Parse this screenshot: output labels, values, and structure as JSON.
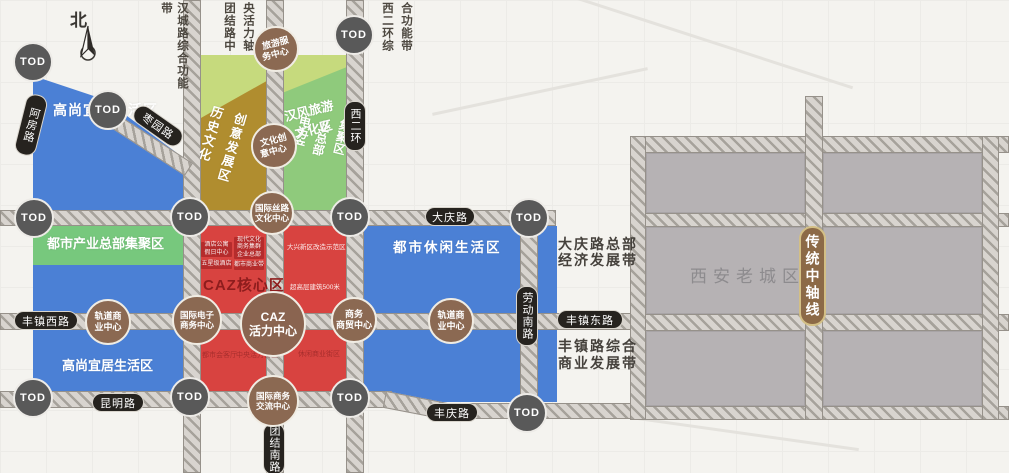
{
  "compass": {
    "north": "北"
  },
  "tod_label": "TOD",
  "belts": {
    "hancheng": "汉城路综合功能带",
    "tuanjie_col_left": "团结路中",
    "tuanjie_col_right": "央活力轴",
    "xierhuan_col_left": "西二环综",
    "xierhuan_col_right": "合功能带",
    "daqing_line1": "大庆路总部",
    "daqing_line2": "经济发展带",
    "fengzhen_line1": "丰镇路综合",
    "fengzhen_line2": "商业发展带"
  },
  "axis_badge": "传统中轴线",
  "old_city_label": "西安老城区",
  "roads": {
    "afang": "阿房路",
    "zaoyuan": "枣园路",
    "xierhuan": "西二环",
    "daqing": "大庆路",
    "fengzhen_west": "丰镇西路",
    "fengzhen_east": "丰镇东路",
    "kunming": "昆明路",
    "fengqing": "丰庆路",
    "tuanjie_south": "团结南路",
    "laodong_south": "劳动南路"
  },
  "zones": {
    "noble1": "高尚宜居生活区",
    "industry_hq": "都市产业总部集聚区",
    "noble2": "高尚宜居生活区",
    "leisure": "都市休闲生活区",
    "caz_core": "CAZ核心区",
    "creative_col1": "历史文化",
    "creative_col2": "创意发展区",
    "hanfeng_line1": "汉风旅游",
    "hanfeng_line2": "文化区",
    "power_col1": "电力产",
    "power_col2": "业总部",
    "power_col3": "集聚区"
  },
  "centers": {
    "travel": {
      "l1": "旅游服",
      "l2": "务中心"
    },
    "creative": {
      "l1": "文化创",
      "l2": "意中心"
    },
    "silk": {
      "l1": "国际丝路",
      "l2": "文化中心"
    },
    "rail1": {
      "l1": "轨道商",
      "l2": "业中心"
    },
    "ecom": {
      "l1": "国际电子",
      "l2": "商务中心"
    },
    "caz": {
      "l1": "CAZ",
      "l2": "活力中心"
    },
    "biztrade": {
      "l1": "商务",
      "l2": "商贸中心"
    },
    "rail2": {
      "l1": "轨道商",
      "l2": "业中心"
    },
    "intl": {
      "l1": "国际商务",
      "l2": "交流中心"
    }
  },
  "caz_details": {
    "chip1_l1": "酒店公寓",
    "chip1_l2": "假日中心",
    "chip2_l1": "现代文化",
    "chip2_l2": "商务集群",
    "chip2_l3": "企业总部",
    "chip3": "五星级酒店",
    "chip4": "都市商业带",
    "r2_top": "大兴新区改造示范区",
    "r2_bottom": "超高层建筑500米",
    "ghost1": "都市会客厅",
    "ghost2": "中央活力街区",
    "ghost3": "休闲商业街区"
  },
  "colors": {
    "blue": "#4b80d5",
    "green": "#77c87d",
    "light_green": "#8fca7c",
    "lime": "#c6da7d",
    "olive": "#b08d2f",
    "red": "#d84340",
    "chip_red": "#b52c2c",
    "tod_gray": "#595959",
    "center_brown": "#8b6952",
    "pill_black": "#26231f",
    "axis_brown": "#8c6a47",
    "old_city_gray": "#b6b2b4"
  }
}
